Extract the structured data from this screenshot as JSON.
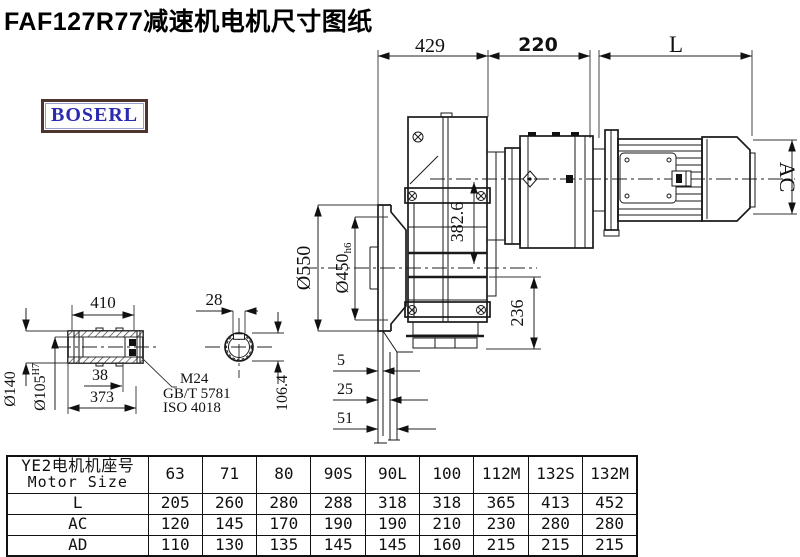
{
  "page": {
    "title": "FAF127R77减速机电机尺寸图纸"
  },
  "logo": {
    "text": "BOSERL"
  },
  "drawing": {
    "dims": {
      "d429": "429",
      "d220": "220",
      "dL": "L",
      "dAC": "AC",
      "d550": "Ø550",
      "d450": "Ø450",
      "d450tol": "h6",
      "d382": "382.6",
      "d236": "236",
      "d5": "5",
      "d25": "25",
      "d51": "51",
      "d410": "410",
      "d28": "28",
      "d140": "Ø140",
      "d105": "Ø105",
      "d105tol": "H7",
      "d38": "38",
      "d373": "373",
      "m24": "M24",
      "gbt": "GB/T 5781",
      "iso": "ISO 4018",
      "d106": "106.4"
    }
  },
  "table": {
    "header_line1": "YE2电机机座号",
    "header_line2": "Motor Size",
    "sizes": [
      "63",
      "71",
      "80",
      "90S",
      "90L",
      "100",
      "112M",
      "132S",
      "132M"
    ],
    "rows": [
      {
        "label": "L",
        "values": [
          "205",
          "260",
          "280",
          "288",
          "318",
          "318",
          "365",
          "413",
          "452"
        ]
      },
      {
        "label": "AC",
        "values": [
          "120",
          "145",
          "170",
          "190",
          "190",
          "210",
          "230",
          "280",
          "280"
        ]
      },
      {
        "label": "AD",
        "values": [
          "110",
          "130",
          "135",
          "145",
          "145",
          "160",
          "215",
          "215",
          "215"
        ]
      }
    ]
  }
}
